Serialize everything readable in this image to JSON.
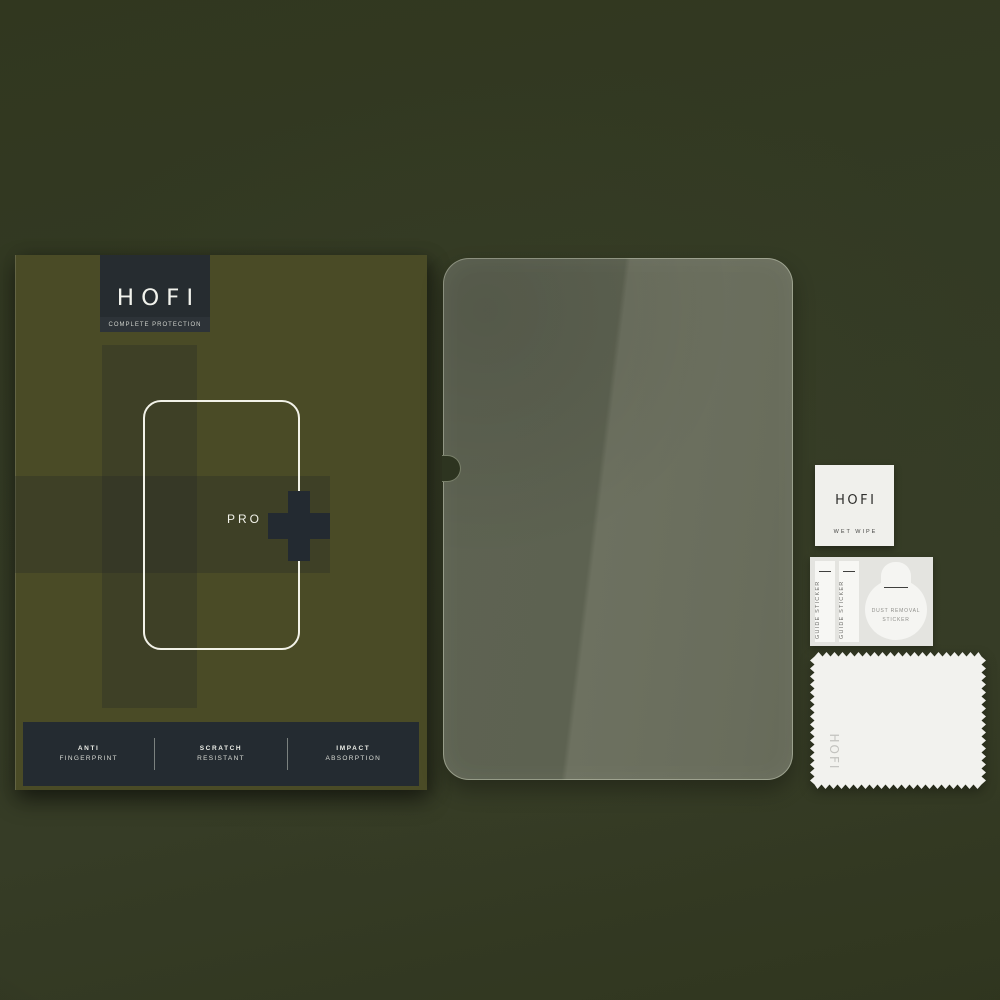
{
  "scene": {
    "description": "HOFI Pro+ tempered glass screen protector kit product photo",
    "background_color": "#333a24"
  },
  "box": {
    "brand": "HOFI",
    "tagline": "COMPLETE PROTECTION",
    "model": "PRO",
    "plus_glyph": "+",
    "features": [
      {
        "line1": "ANTI",
        "line2": "FINGERPRINT"
      },
      {
        "line1": "SCRATCH",
        "line2": "RESISTANT"
      },
      {
        "line1": "IMPACT",
        "line2": "ABSORPTION"
      }
    ],
    "colors": {
      "box_olive": "#4a4b26",
      "band_overlay": "#3c3f2b",
      "logo_block": "#262c30",
      "features_bar": "#242b31",
      "plus": "#232a31",
      "outline": "#f2f2e8"
    }
  },
  "glass": {
    "colors": {
      "left": "#5d6251",
      "right": "#6d7160",
      "rim": "#e1e6d0"
    },
    "camera_notch": "left-edge cutout"
  },
  "accessories": {
    "wet_wipe": {
      "brand": "HOFI",
      "label": "WET WIPE"
    },
    "guide_stickers": [
      {
        "label": "GUIDE STICKER"
      },
      {
        "label": "GUIDE STICKER"
      }
    ],
    "dust_removal_sticker": {
      "line1": "DUST REMOVAL",
      "line2": "STICKER"
    },
    "cloth": {
      "brand": "HOFI"
    }
  }
}
